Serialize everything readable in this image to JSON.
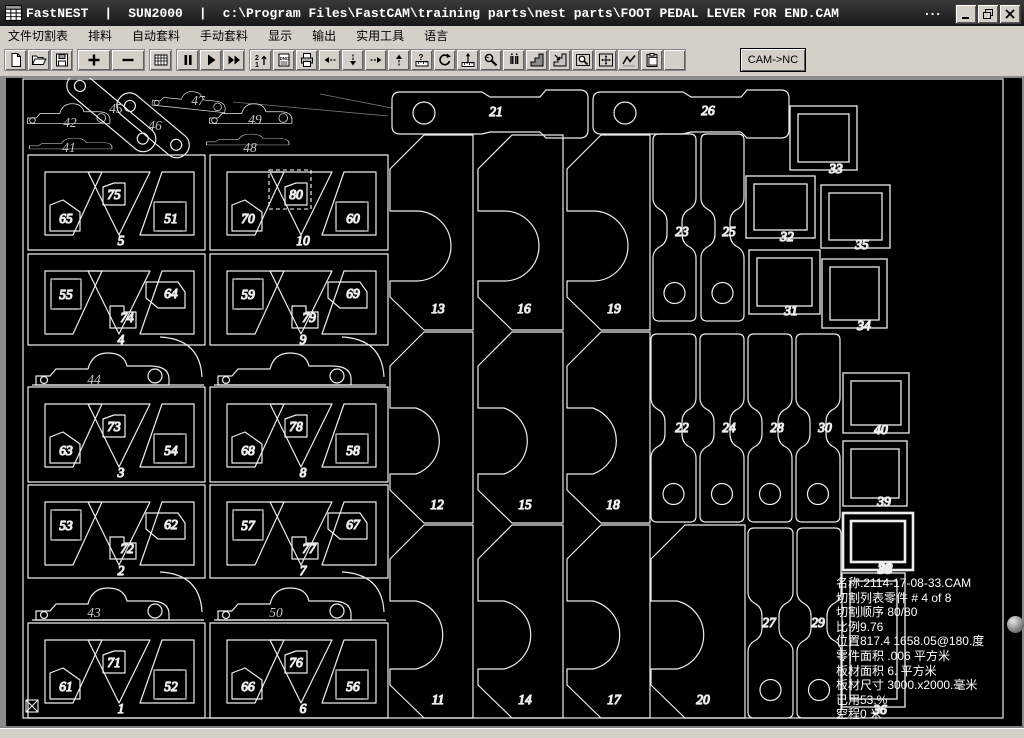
{
  "window": {
    "app_name": "FastNEST",
    "separator": "|",
    "license": "SUN2000",
    "file_path": "c:\\Program Files\\FastCAM\\training parts\\nest parts\\FOOT PEDAL LEVER FOR END.CAM",
    "ellipsis": "...",
    "controls": {
      "minimize": "minimize-button",
      "restore": "restore-button",
      "close": "close-button"
    }
  },
  "menu": {
    "items": [
      "文件切割表",
      "排料",
      "自动套料",
      "手动套料",
      "显示",
      "输出",
      "实用工具",
      "语言"
    ]
  },
  "toolbar": {
    "groups": [
      [
        "new-file-icon",
        "open-folder-icon",
        "save-icon"
      ],
      [
        "plus-icon",
        "minus-icon"
      ],
      [
        "grid-icon"
      ],
      [
        "pause-icon",
        "play-icon",
        "fast-forward-icon"
      ],
      [
        "sequence-21-icon",
        "nc-code-icon",
        "print-icon",
        "arrow-left-icon",
        "arrow-down-icon",
        "arrow-right-icon",
        "arrow-up-icon",
        "measure-ruler-icon",
        "rotate-icon",
        "height-gauge-icon",
        "magnify-wrench-icon",
        "pierce-points-icon",
        "step-block-icon",
        "step-block-arrow-icon",
        "zoom-window-icon",
        "zoom-extents-icon",
        "path-curve-icon",
        "clipboard-icon",
        "blank-icon"
      ]
    ],
    "cam_to_nc_label": "CAM->NC"
  },
  "canvas": {
    "colors": {
      "background": "#000000",
      "outline": "#ededed",
      "label": "#c6c6c6",
      "traverse": "#555555",
      "status_text": "#ffffff"
    },
    "status_lines": [
      "名称:2114-17-08-33.CAM",
      "切割列表零件  # 4 of  8",
      "切割顺序 80/80",
      "比例9.76",
      "位置817.4 1658.05@180.度",
      "零件面积  .006 平方米",
      "板材面积 6. 平方米",
      "板材尺寸  3000.x2000.毫米",
      "已用53.%",
      "空程0 米"
    ],
    "plate_boundary": {
      "x": 23,
      "y": 79,
      "w": 980,
      "h": 639,
      "size_label": "3000x2000"
    },
    "selection": {
      "part": "80",
      "x": 269,
      "y": 170,
      "w": 42,
      "h": 39
    },
    "plates": [
      {
        "n": "5",
        "x": 28,
        "y": 155,
        "w": 177,
        "h": 95,
        "v": "A",
        "a": "65",
        "b": "75",
        "c": "51"
      },
      {
        "n": "10",
        "x": 210,
        "y": 155,
        "w": 178,
        "h": 95,
        "v": "A",
        "a": "70",
        "b": "80",
        "c": "60"
      },
      {
        "n": "4",
        "x": 28,
        "y": 254,
        "w": 177,
        "h": 91,
        "v": "B",
        "a": "55",
        "b": "74",
        "c": "64"
      },
      {
        "n": "9",
        "x": 210,
        "y": 254,
        "w": 178,
        "h": 91,
        "v": "B",
        "a": "59",
        "b": "79",
        "c": "69"
      },
      {
        "n": "3",
        "x": 28,
        "y": 387,
        "w": 177,
        "h": 95,
        "v": "A",
        "a": "63",
        "b": "73",
        "c": "54"
      },
      {
        "n": "8",
        "x": 210,
        "y": 387,
        "w": 178,
        "h": 95,
        "v": "A",
        "a": "68",
        "b": "78",
        "c": "58"
      },
      {
        "n": "2",
        "x": 28,
        "y": 485,
        "w": 177,
        "h": 93,
        "v": "B",
        "a": "53",
        "b": "72",
        "c": "62"
      },
      {
        "n": "7",
        "x": 210,
        "y": 485,
        "w": 178,
        "h": 93,
        "v": "B",
        "a": "57",
        "b": "77",
        "c": "67"
      },
      {
        "n": "1",
        "x": 28,
        "y": 623,
        "w": 177,
        "h": 95,
        "v": "A",
        "a": "61",
        "b": "71",
        "c": "52"
      },
      {
        "n": "6",
        "x": 210,
        "y": 623,
        "w": 178,
        "h": 95,
        "v": "A",
        "a": "66",
        "b": "76",
        "c": "56"
      }
    ],
    "levers": [
      {
        "n": "42",
        "x": 25,
        "y": 100,
        "rot": 0,
        "kind": "pedal",
        "s": 0.62,
        "lx": 70,
        "ly": 127
      },
      {
        "n": "41",
        "x": 27,
        "y": 136,
        "rot": 0,
        "kind": "flat",
        "s": 0.62,
        "lx": 69,
        "ly": 152
      },
      {
        "n": "45",
        "x": 78,
        "y": 68,
        "rot": 40,
        "kind": "link",
        "s": 1.0,
        "lx": 116,
        "ly": 113
      },
      {
        "n": "46",
        "x": 128,
        "y": 88,
        "rot": 40,
        "kind": "link",
        "s": 0.8,
        "lx": 155,
        "ly": 130
      },
      {
        "n": "47",
        "x": 152,
        "y": 84,
        "rot": 6,
        "kind": "pedal",
        "s": 0.55,
        "lx": 198,
        "ly": 105
      },
      {
        "n": "49",
        "x": 207,
        "y": 100,
        "rot": 0,
        "kind": "pedal",
        "s": 0.62,
        "lx": 255,
        "ly": 124
      },
      {
        "n": "48",
        "x": 204,
        "y": 132,
        "rot": 0,
        "kind": "flat",
        "s": 0.62,
        "lx": 250,
        "ly": 152
      },
      {
        "n": "44",
        "x": 32,
        "y": 347,
        "rot": 0,
        "kind": "band",
        "s": 1.0,
        "lx": 94,
        "ly": 384
      },
      {
        "n": "",
        "x": 214,
        "y": 347,
        "rot": 0,
        "kind": "band",
        "s": 1.0,
        "lx": 0,
        "ly": 0
      },
      {
        "n": "43",
        "x": 32,
        "y": 582,
        "rot": 0,
        "kind": "band",
        "s": 1.0,
        "lx": 94,
        "ly": 617
      },
      {
        "n": "50",
        "x": 214,
        "y": 582,
        "rot": 0,
        "kind": "band",
        "s": 1.0,
        "lx": 276,
        "ly": 617
      }
    ],
    "bigparts": [
      {
        "n": "13",
        "x": 390,
        "y": 135,
        "w": 83,
        "h": 195,
        "lx": 438,
        "ly": 313
      },
      {
        "n": "16",
        "x": 478,
        "y": 135,
        "w": 85,
        "h": 195,
        "lx": 524,
        "ly": 313
      },
      {
        "n": "19",
        "x": 567,
        "y": 135,
        "w": 83,
        "h": 195,
        "lx": 614,
        "ly": 313
      },
      {
        "n": "12",
        "x": 390,
        "y": 332,
        "w": 83,
        "h": 191,
        "lx": 437,
        "ly": 509
      },
      {
        "n": "15",
        "x": 478,
        "y": 332,
        "w": 85,
        "h": 191,
        "lx": 525,
        "ly": 509
      },
      {
        "n": "18",
        "x": 567,
        "y": 332,
        "w": 83,
        "h": 191,
        "lx": 613,
        "ly": 509
      },
      {
        "n": "11",
        "x": 390,
        "y": 525,
        "w": 83,
        "h": 193,
        "lx": 438,
        "ly": 704
      },
      {
        "n": "14",
        "x": 478,
        "y": 525,
        "w": 85,
        "h": 193,
        "lx": 525,
        "ly": 704
      },
      {
        "n": "17",
        "x": 567,
        "y": 525,
        "w": 83,
        "h": 193,
        "lx": 614,
        "ly": 704
      },
      {
        "n": "20",
        "x": 651,
        "y": 525,
        "w": 94,
        "h": 193,
        "lx": 703,
        "ly": 704
      }
    ],
    "bars": [
      {
        "n": "21",
        "x": 392,
        "y": 88,
        "w": 196,
        "h": 46,
        "lx": 496,
        "ly": 116
      },
      {
        "n": "26",
        "x": 593,
        "y": 88,
        "w": 195,
        "h": 46,
        "lx": 708,
        "ly": 115
      }
    ],
    "bones": [
      {
        "n": "23",
        "x": 653,
        "y": 134,
        "w": 43,
        "h": 187,
        "lx": 682,
        "ly": 236
      },
      {
        "n": "25",
        "x": 701,
        "y": 134,
        "w": 43,
        "h": 187,
        "lx": 729,
        "ly": 236
      },
      {
        "n": "22",
        "x": 651,
        "y": 334,
        "w": 45,
        "h": 188,
        "lx": 682,
        "ly": 432
      },
      {
        "n": "24",
        "x": 700,
        "y": 334,
        "w": 44,
        "h": 188,
        "lx": 729,
        "ly": 432
      },
      {
        "n": "28",
        "x": 748,
        "y": 334,
        "w": 44,
        "h": 188,
        "lx": 777,
        "ly": 432
      },
      {
        "n": "30",
        "x": 796,
        "y": 334,
        "w": 44,
        "h": 188,
        "lx": 825,
        "ly": 432
      },
      {
        "n": "27",
        "x": 748,
        "y": 528,
        "w": 45,
        "h": 190,
        "lx": 769,
        "ly": 627
      },
      {
        "n": "29",
        "x": 797,
        "y": 528,
        "w": 44,
        "h": 190,
        "lx": 818,
        "ly": 627
      }
    ],
    "squares": [
      {
        "n": "33",
        "x": 790,
        "y": 106,
        "w": 67,
        "h": 64,
        "lx": 836,
        "ly": 173,
        "thick": false
      },
      {
        "n": "32",
        "x": 746,
        "y": 176,
        "w": 69,
        "h": 62,
        "lx": 787,
        "ly": 241,
        "thick": false
      },
      {
        "n": "35",
        "x": 821,
        "y": 185,
        "w": 69,
        "h": 63,
        "lx": 862,
        "ly": 249,
        "thick": false
      },
      {
        "n": "31",
        "x": 749,
        "y": 250,
        "w": 71,
        "h": 64,
        "lx": 791,
        "ly": 315,
        "thick": false
      },
      {
        "n": "34",
        "x": 822,
        "y": 259,
        "w": 65,
        "h": 69,
        "lx": 864,
        "ly": 330,
        "thick": false
      },
      {
        "n": "40",
        "x": 843,
        "y": 373,
        "w": 66,
        "h": 60,
        "lx": 881,
        "ly": 434,
        "thick": false
      },
      {
        "n": "39",
        "x": 843,
        "y": 441,
        "w": 64,
        "h": 65,
        "lx": 884,
        "ly": 506,
        "thick": false
      },
      {
        "n": "38",
        "x": 843,
        "y": 513,
        "w": 70,
        "h": 57,
        "lx": 885,
        "ly": 573,
        "thick": true
      },
      {
        "n": "36",
        "x": 842,
        "y": 573,
        "w": 63,
        "h": 134,
        "lx": 880,
        "ly": 714,
        "thick": false
      }
    ],
    "traverse_lines": [
      [
        70,
        130,
        430,
        500
      ],
      [
        130,
        160,
        520,
        690
      ],
      [
        300,
        240,
        90,
        560
      ],
      [
        480,
        130,
        240,
        430
      ],
      [
        540,
        160,
        790,
        620
      ],
      [
        640,
        210,
        410,
        660
      ],
      [
        700,
        300,
        330,
        480
      ],
      [
        770,
        180,
        880,
        690
      ],
      [
        860,
        260,
        520,
        610
      ],
      [
        400,
        110,
        850,
        560
      ],
      [
        260,
        660,
        660,
        260
      ],
      [
        160,
        460,
        560,
        690
      ],
      [
        820,
        120,
        430,
        380
      ],
      [
        900,
        430,
        560,
        160
      ]
    ],
    "leader_lines": [
      [
        233,
        102,
        388,
        116
      ],
      [
        320,
        94,
        392,
        108
      ]
    ]
  }
}
